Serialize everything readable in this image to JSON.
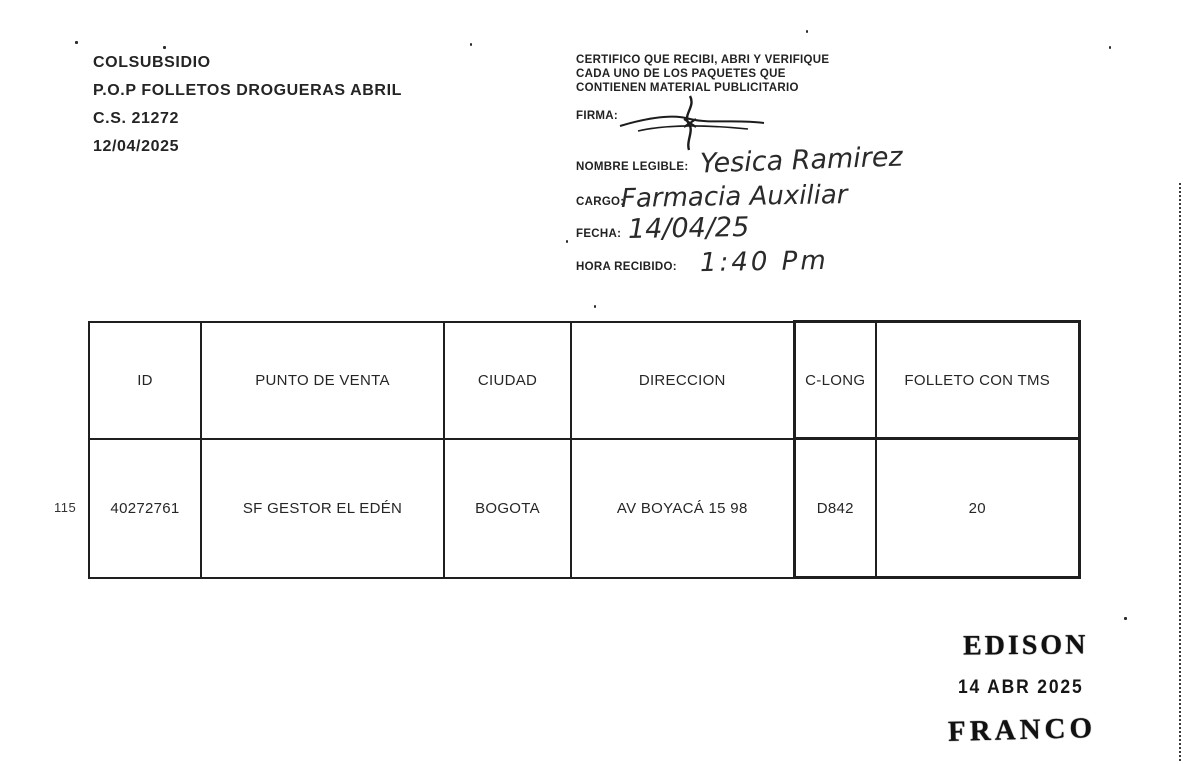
{
  "header_left": {
    "company": "COLSUBSIDIO",
    "campaign": "P.O.P FOLLETOS DROGUERAS ABRIL",
    "cs_number": "C.S. 21272",
    "date": "12/04/2025"
  },
  "certification": {
    "line1": "CERTIFICO QUE RECIBI, ABRI Y VERIFIQUE",
    "line2": "CADA  UNO DE LOS PAQUETES QUE",
    "line3": "CONTIENEN MATERIAL  PUBLICITARIO"
  },
  "fields": {
    "firma_label": "FIRMA:",
    "nombre_label": "NOMBRE LEGIBLE:",
    "nombre_value": "Yesica Ramirez",
    "cargo_label": "CARGO:",
    "cargo_value": "Farmacia Auxiliar",
    "fecha_label": "FECHA:",
    "fecha_value": "14/04/25",
    "hora_label": "HORA RECIBIDO:",
    "hora_value": "1:40 Pm"
  },
  "table": {
    "row_index": "115",
    "columns": [
      "ID",
      "PUNTO DE VENTA",
      "CIUDAD",
      "DIRECCION",
      "C-LONG",
      "FOLLETO CON TMS"
    ],
    "rows": [
      [
        "40272761",
        "SF GESTOR EL EDÉN",
        "BOGOTA",
        "AV BOYACÁ 15 98",
        "D842",
        "20"
      ]
    ]
  },
  "stamp": {
    "name_top": "EDISON",
    "date": "14 ABR 2025",
    "name_bottom": "FRANCO"
  }
}
